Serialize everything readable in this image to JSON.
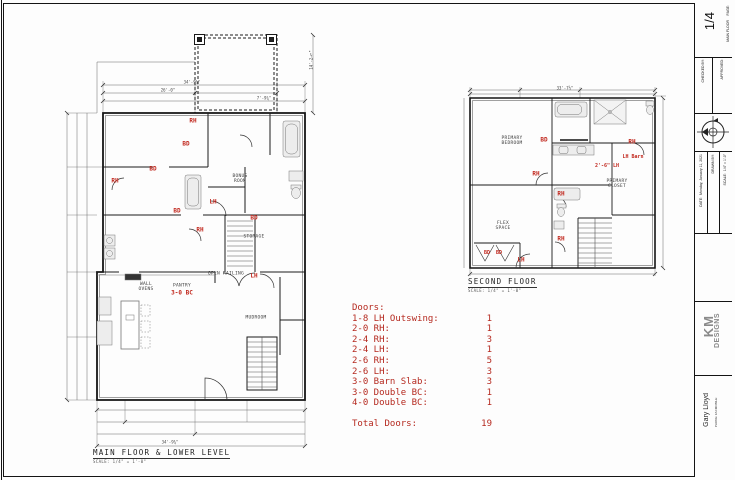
{
  "palette": {
    "line": "#1a1a1a",
    "red": "#c1271d",
    "schedule_red": "#b5291f",
    "fixture_fill": "#ededed"
  },
  "main_plan": {
    "title": "MAIN FLOOR & LOWER LEVEL",
    "scale": "SCALE: 1/4\" = 1'-0\"",
    "door_labels": [
      "RH",
      "BD",
      "BD",
      "RH",
      "LH",
      "BD",
      "RH",
      "BD",
      "LH",
      "3-0 BC"
    ],
    "room_labels": [
      "BONUS ROOM",
      "STORAGE",
      "PANTRY",
      "WALL OVENS",
      "OPEN RAILING",
      "MUDROOM"
    ],
    "dims": [
      "34'-9¾\"",
      "26'-0\"",
      "7'-9¾\"",
      "34'-9¾\"",
      "14'-2½\""
    ]
  },
  "second_plan": {
    "title": "SECOND FLOOR",
    "scale": "SCALE: 1/4\" = 1'-0\"",
    "door_labels": [
      "BD",
      "RH",
      "LH Barn",
      "2'-6\" LH",
      "RH",
      "RH",
      "RH",
      "LH",
      "BD",
      "BD"
    ],
    "room_labels": [
      "PRIMARY BEDROOM",
      "PRIMARY CLOSET",
      "FLEX SPACE"
    ],
    "dims": [
      "33'-7½\""
    ]
  },
  "door_schedule": {
    "heading": "Doors:",
    "rows": [
      {
        "label": "1-8 LH Outswing:",
        "count": "1"
      },
      {
        "label": "2-0 RH:",
        "count": "1"
      },
      {
        "label": "2-4 RH:",
        "count": "3"
      },
      {
        "label": "2-4 LH:",
        "count": "1"
      },
      {
        "label": "2-6 RH:",
        "count": "5"
      },
      {
        "label": "2-6 LH:",
        "count": "3"
      },
      {
        "label": "3-0 Barn Slab:",
        "count": "3"
      },
      {
        "label": "3-0 Double BC:",
        "count": "1"
      },
      {
        "label": "4-0 Double BC:",
        "count": "1"
      }
    ],
    "total_label": "Total Doors:",
    "total": "19"
  },
  "title_block": {
    "page_label": "PAGE:",
    "page_number": "1/4",
    "sheet_name": "MAIN FLOOR",
    "approved_label": "APPROVED:",
    "checked_label": "CHECKED BY:",
    "scale": "SCALE:  1/4\" = 1'-0\"",
    "drawn_label": "DRAWN BY:",
    "date": "DATE:  Monday, January 11, 2021",
    "logo_top": "KM",
    "logo_bottom": "DESIGNS",
    "author": "Gary Lloyd",
    "contact_lines": [
      "PHONE:",
      "FAX:",
      "MOBILE:"
    ]
  }
}
